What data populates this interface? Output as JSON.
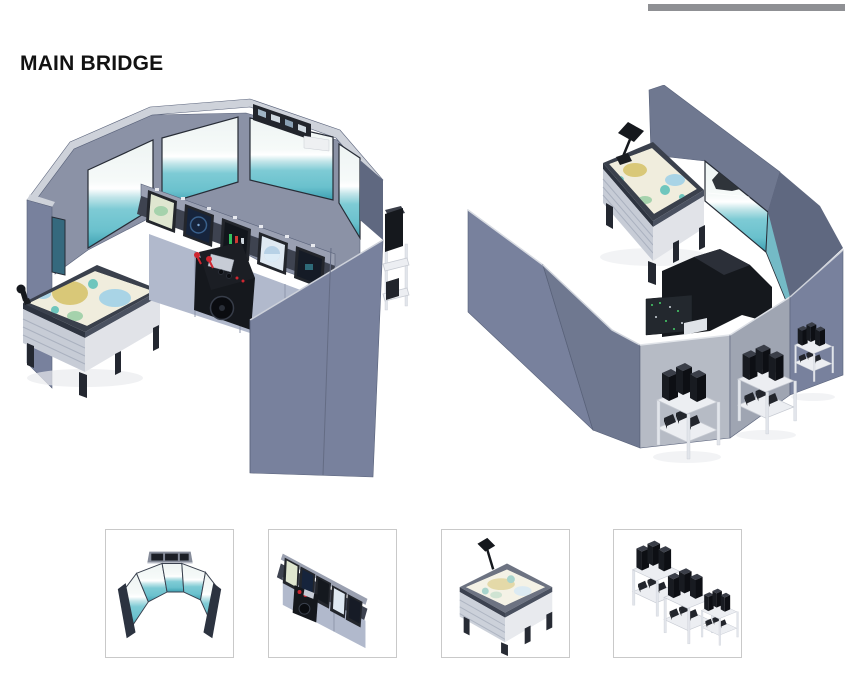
{
  "page": {
    "title": "MAIN BRIDGE"
  },
  "renders": {
    "front": {
      "id": "bridge-front-perspective"
    },
    "rear": {
      "id": "bridge-rear-perspective"
    }
  },
  "thumbnails": [
    {
      "id": "panoramic-display-wall"
    },
    {
      "id": "bridge-console"
    },
    {
      "id": "chart-table"
    },
    {
      "id": "equipment-racks"
    }
  ],
  "colors": {
    "bg": "#ffffff",
    "rule": "#8f9094",
    "title": "#121212",
    "thumbBorder": "#c9c9c9",
    "wall": "#78819d",
    "wallDark": "#5f6880",
    "wallMid": "#6f7890",
    "wallLight": "#b6bbc5",
    "wallLighter": "#9fa5b2",
    "wallInner": "#8b92a6",
    "rim": "#ced2da",
    "edge": "#59627a",
    "sky": "#eef4f3",
    "sea": "#6ac1cd",
    "seaDeep": "#3d9fb1",
    "frame": "#272c36",
    "bezel": "#23262c",
    "deskTop": "#3e4350",
    "deskFront": "#b1b9cc",
    "shelfGray": "#9aa0b2",
    "tick": "#e8eaef",
    "black": "#15181d",
    "blackSoft": "#22252c",
    "blackTop": "#3a3e48",
    "red": "#ce2630",
    "radarNavy": "#16243c",
    "ecdis": "#dfe6d0",
    "engine": "#12161c",
    "sphereBg": "#dfe9f2",
    "sphere": "#b7d1e6",
    "mapPaper": "#f0eddd",
    "mapLand": "#d9c878",
    "mapWater": "#a9d4e6",
    "mapTeal": "#6fc6bd",
    "mapGreen": "#a5d2ac",
    "tableFrame": "#3a404c",
    "tableEdge": "#2e3440",
    "tableBody": "#c7ccd6",
    "tableSide": "#e1e3e8",
    "leg": "#232730",
    "rackShelf": "#eceef2",
    "rackLeg": "#e2e5eb",
    "rackStroke": "#c6cad2",
    "wedge": "#22252c",
    "label": "#dfe3e8",
    "pcb": "#23282e",
    "pcbDot": "#46d06a",
    "shadow": "#e9ebee",
    "shipDark": "#2f343a"
  }
}
